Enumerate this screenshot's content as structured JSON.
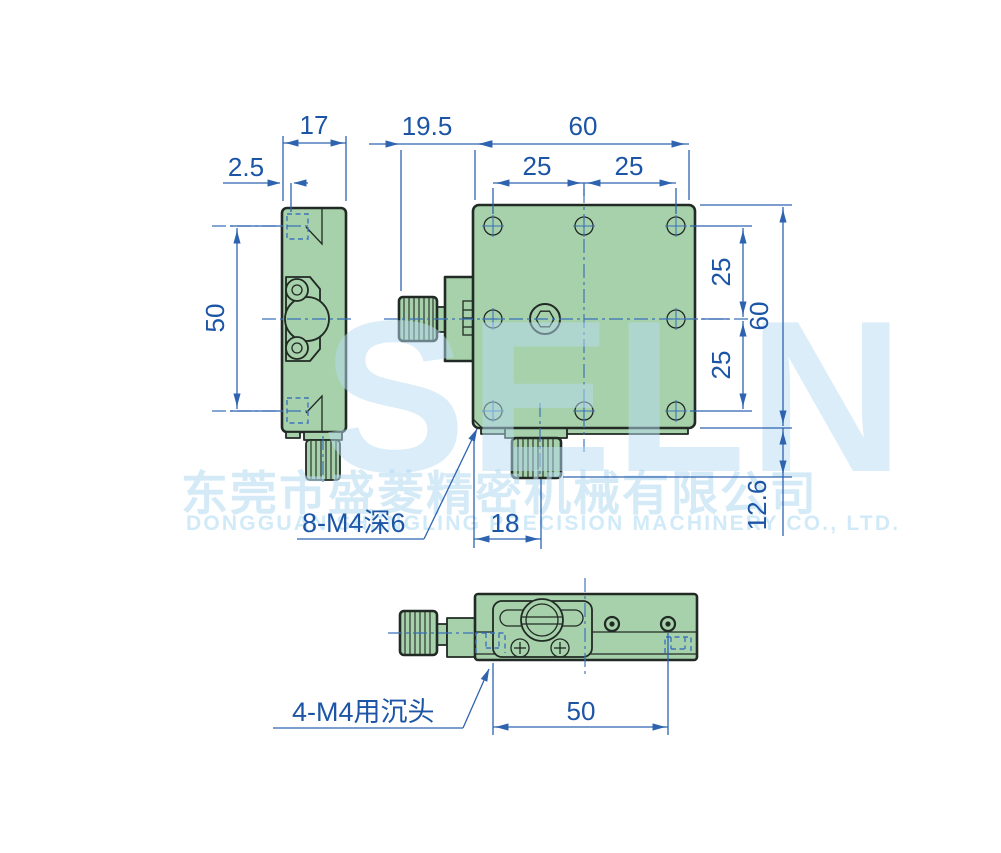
{
  "drawing": {
    "title": "translation-stage-dimension-drawing",
    "dimensions": {
      "side_width": "17",
      "side_counterbore_offset": "2.5",
      "side_hole_span": "50",
      "knob_length": "19.5",
      "body_width": "60",
      "hole_pitch_left": "25",
      "hole_pitch_right": "25",
      "right_pitch_upper": "25",
      "body_height": "60",
      "right_pitch_lower": "25",
      "bottom_knob_height": "12.6",
      "screw_offset": "18",
      "bottom_hole_span": "50"
    },
    "annotations": {
      "top_thread_note": "8-M4深6",
      "bottom_counterbore_note": "4-M4用沉头"
    },
    "watermark": {
      "logo": "SELN",
      "company_cn": "东莞市盛菱精密机械有限公司",
      "company_en": "DONGGUAN SHENGLING PRECISION MACHINERY CO., LTD."
    },
    "colors": {
      "part_fill": "#a7d1aa",
      "outline": "#212a24",
      "dimension_blue": "#1c55a5",
      "watermark_blue": "#cfe9f8"
    }
  }
}
